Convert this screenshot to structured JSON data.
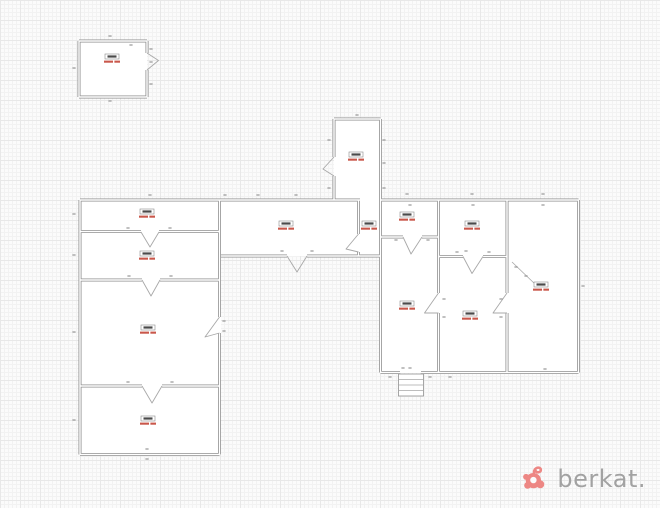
{
  "meta": {
    "content_type": "architectural floor plan drawing on graph-paper background",
    "annotations_note": "room labels and dimension numbers are rendered at sub-legible pixel size in the source image",
    "labels_legible": false
  },
  "canvas": {
    "width": 660,
    "height": 508
  },
  "colors": {
    "grid_minor": "#f2f2f2",
    "grid_major": "#e8e8e8",
    "wall": "#8f8f8f",
    "wall_fill": "#ffffff",
    "door": "#a8a8a8",
    "label_box": "#8a8a8a",
    "label_text": "#4a4a4a",
    "label_area": "#c0392b",
    "dim": "#909090",
    "logo_icon": "#ed8784",
    "logo_text": "#a2a2a2"
  },
  "watermark": {
    "text": "berkat.",
    "icon": "berkat-flower-logo"
  },
  "plan": {
    "buildings": [
      {
        "id": "detached-outbuilding",
        "desc": "small square building, top-left, door on east wall"
      },
      {
        "id": "north-annex",
        "desc": "tall narrow room above main block, door on west wall"
      },
      {
        "id": "left-wing",
        "desc": "four stacked rooms, doors between rooms and exit on east wall"
      },
      {
        "id": "corridor",
        "desc": "horizontal corridor linking left wing to right block, exit door in south wall"
      },
      {
        "id": "vestibule",
        "desc": "small lobby between corridor and right block"
      },
      {
        "id": "right-block",
        "desc": "six-room block with south entrance porch and steps"
      }
    ],
    "room_labels": [
      {
        "room": "detached-outbuilding",
        "x": 112,
        "y": 60
      },
      {
        "room": "north-annex",
        "x": 356,
        "y": 158
      },
      {
        "room": "left-wing-room-a",
        "x": 147,
        "y": 215
      },
      {
        "room": "left-wing-room-b",
        "x": 147,
        "y": 257
      },
      {
        "room": "left-wing-room-c",
        "x": 148,
        "y": 331
      },
      {
        "room": "left-wing-room-d",
        "x": 148,
        "y": 422
      },
      {
        "room": "corridor",
        "x": 286,
        "y": 227
      },
      {
        "room": "vestibule",
        "x": 369,
        "y": 227
      },
      {
        "room": "right-block-top-left",
        "x": 407,
        "y": 218
      },
      {
        "room": "right-block-top-middle",
        "x": 472,
        "y": 227
      },
      {
        "room": "right-block-big-east",
        "x": 541,
        "y": 288
      },
      {
        "room": "right-block-bottom-left",
        "x": 407,
        "y": 307
      },
      {
        "room": "right-block-bottom-middle",
        "x": 470,
        "y": 317
      }
    ],
    "dim_marks": [
      [
        110,
        36
      ],
      [
        74,
        68
      ],
      [
        110,
        101
      ],
      [
        151,
        49
      ],
      [
        151,
        62
      ],
      [
        151,
        84
      ],
      [
        131,
        45
      ],
      [
        357,
        115
      ],
      [
        329,
        140
      ],
      [
        329,
        188
      ],
      [
        384,
        140
      ],
      [
        384,
        163
      ],
      [
        384,
        188
      ],
      [
        225,
        195
      ],
      [
        258,
        195
      ],
      [
        296,
        195
      ],
      [
        282,
        251
      ],
      [
        312,
        251
      ],
      [
        150,
        195
      ],
      [
        74,
        214
      ],
      [
        74,
        255
      ],
      [
        74,
        332
      ],
      [
        74,
        420
      ],
      [
        147,
        459
      ],
      [
        147,
        449
      ],
      [
        128,
        228
      ],
      [
        170,
        228
      ],
      [
        129,
        276
      ],
      [
        171,
        276
      ],
      [
        128,
        382
      ],
      [
        172,
        382
      ],
      [
        224,
        321
      ],
      [
        224,
        331
      ],
      [
        407,
        194
      ],
      [
        472,
        194
      ],
      [
        543,
        194
      ],
      [
        410,
        205
      ],
      [
        473,
        205
      ],
      [
        543,
        205
      ],
      [
        583,
        286
      ],
      [
        450,
        377
      ],
      [
        545,
        369
      ],
      [
        390,
        377
      ],
      [
        430,
        377
      ],
      [
        396,
        240
      ],
      [
        428,
        240
      ],
      [
        457,
        252
      ],
      [
        489,
        252
      ],
      [
        466,
        251
      ],
      [
        444,
        299
      ],
      [
        444,
        317
      ],
      [
        501,
        299
      ],
      [
        501,
        317
      ],
      [
        516,
        267
      ],
      [
        526,
        276
      ],
      [
        403,
        368
      ],
      [
        410,
        368
      ]
    ]
  }
}
